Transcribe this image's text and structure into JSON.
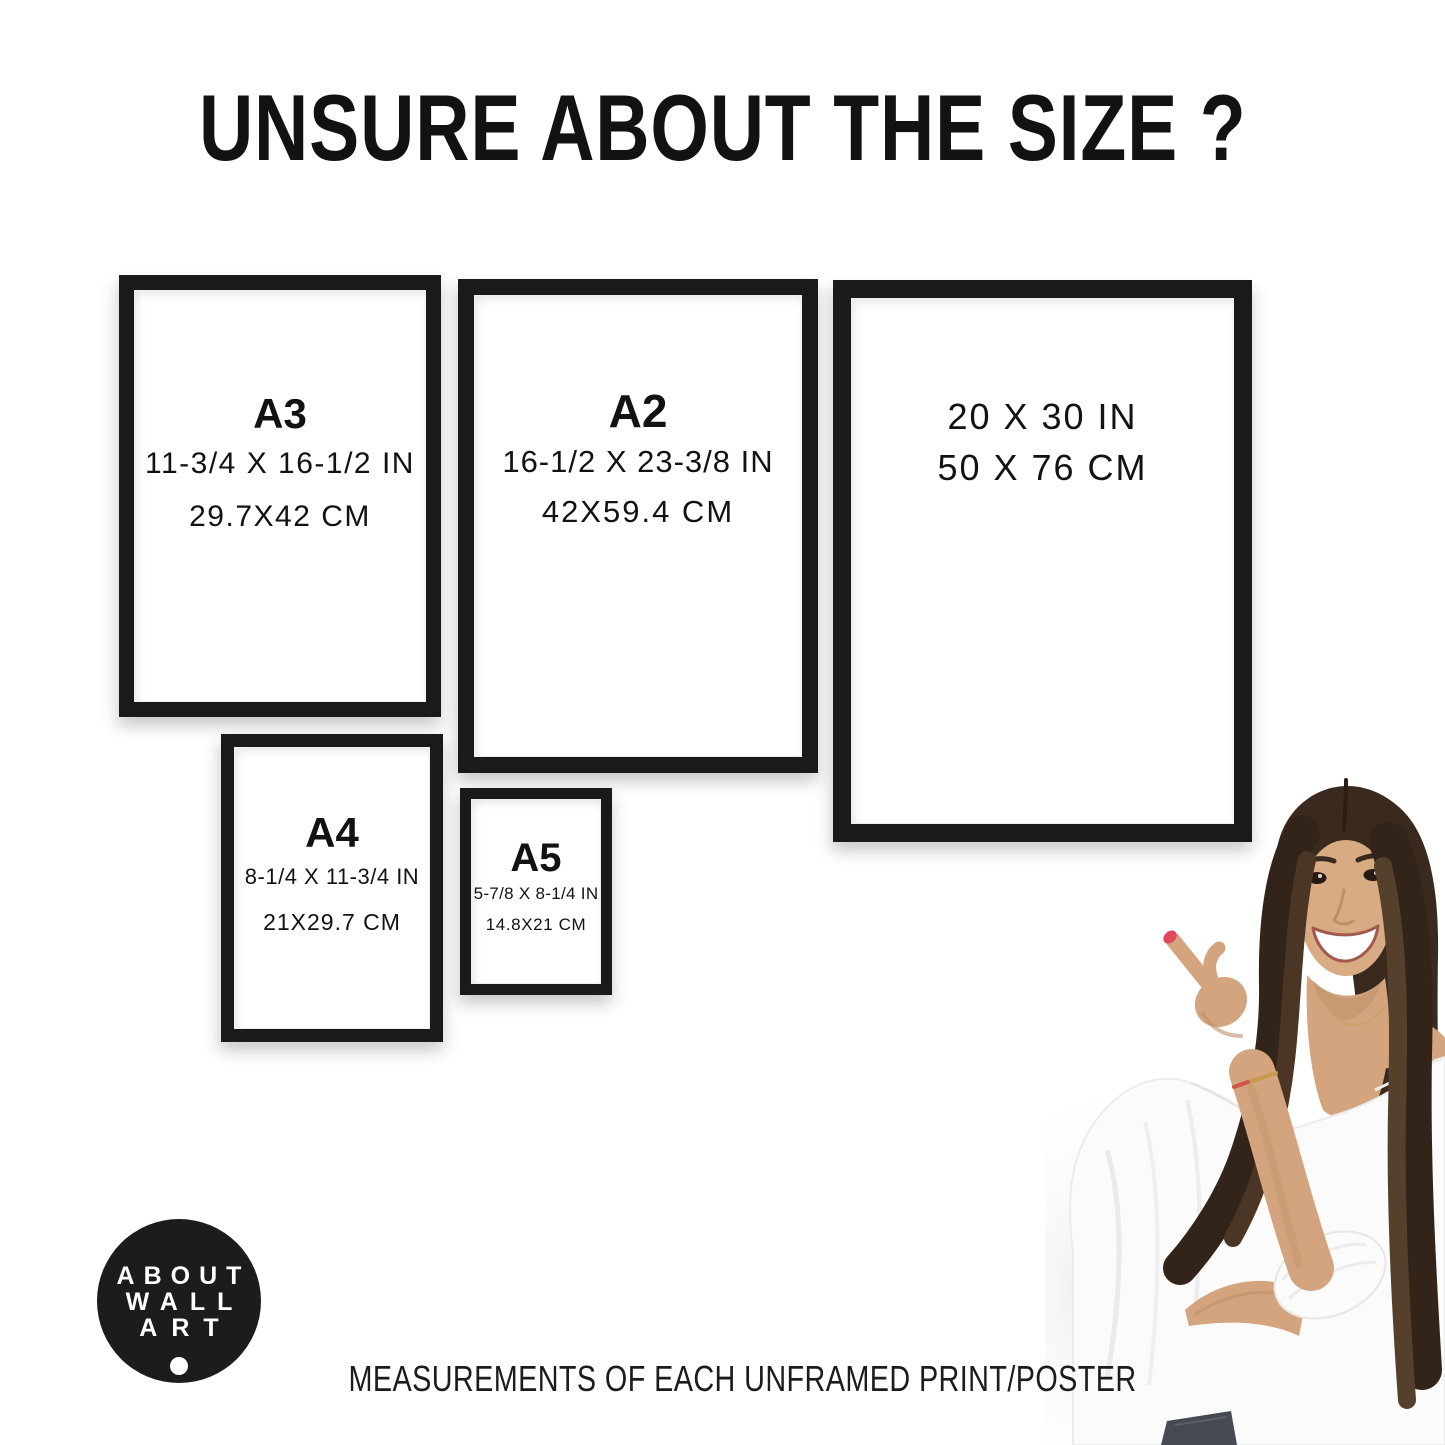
{
  "title": "UNSURE ABOUT THE SIZE ?",
  "frames": [
    {
      "label": "A3",
      "size_in": "11-3/4 X 16-1/2 IN",
      "size_cm": "29.7X42 CM"
    },
    {
      "label": "A2",
      "size_in": "16-1/2 X 23-3/8 IN",
      "size_cm": "42X59.4 CM"
    },
    {
      "label": "",
      "size_in": "20 X 30 IN",
      "size_cm": "50 X 76 CM"
    },
    {
      "label": "A4",
      "size_in": "8-1/4 X 11-3/4 IN",
      "size_cm": "21X29.7 CM"
    },
    {
      "label": "A5",
      "size_in": "5-7/8 X 8-1/4 IN",
      "size_cm": "14.8X21 CM"
    }
  ],
  "logo": {
    "line1": "ABOUT",
    "line2": "WALL",
    "line3": "ART"
  },
  "footer_caption": "MEASUREMENTS OF EACH UNFRAMED PRINT/POSTER",
  "colors": {
    "frame_black": "#1a1a1a",
    "text_black": "#121212",
    "logo_bg": "#1c1c1a",
    "logo_text": "#ffffff",
    "skin_tan": "#d3a47d",
    "hair_brown": "#3a2a1d",
    "blouse_white": "#fbfbfb",
    "nail_red": "#e2485c",
    "jeans_gray": "#454a52"
  }
}
